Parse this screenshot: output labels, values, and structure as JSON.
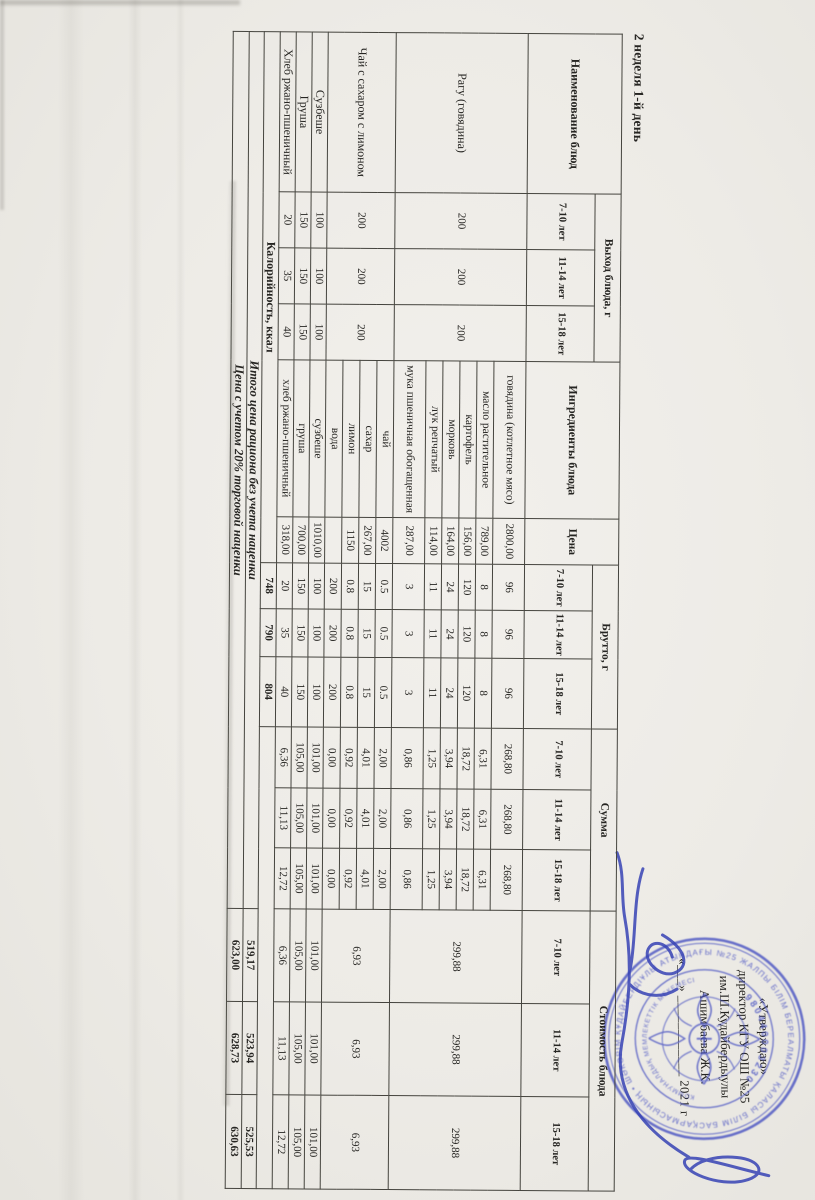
{
  "page": {
    "title": "2 неделя 1-й день"
  },
  "approval": {
    "line1": "«Утверждаю»",
    "line2": "директор КГУ ОШ №25",
    "line3": "им.Ш.Кудайбердыулы",
    "line4": "Ашимбаева Ж.К.",
    "date_line": "«___» ____________ 2021 г"
  },
  "stamp": {
    "ring_text": "АЛМАТЫ ҚАЛАСЫ БІЛІМ БАСҚАРМАСЫНЫҢ • ШӘКӘРІМ ҚҰДАЙБЕРДІҰЛЫ АТЫНДАҒЫ №25 ЖАЛПЫ БІЛІМ БЕРЕТІН МЕКТЕБІ •",
    "inner_bottom_text": "КОММУНАЛДЫҚ МЕМЛЕКЕТТІК МЕКЕМЕСІ",
    "bin": "980440003230",
    "color": "#4a53c2"
  },
  "signature_color": "#3743b5",
  "table": {
    "headers": {
      "name": "Наименование блюд",
      "yield": "Выход блюда, г",
      "ingredients": "Ингредиенты блюда",
      "price": "Цена",
      "brutto": "Брутто, г",
      "sum": "Сумма",
      "cost": "Стоимость блюда",
      "ages": [
        "7-10 лет",
        "11-14 лет",
        "15-18 лет"
      ]
    },
    "dishes": [
      {
        "name": "Рагу (говядина)",
        "yield": [
          "200",
          "200",
          "200"
        ],
        "cost": [
          "299,88",
          "299,88",
          "299,88"
        ],
        "ingredients": [
          {
            "name": "говядина (котлетное мясо)",
            "price": "2800,00",
            "brutto": [
              "96",
              "96",
              "96"
            ],
            "sum": [
              "268,80",
              "268,80",
              "268,80"
            ]
          },
          {
            "name": "масло растительное",
            "price": "789,00",
            "brutto": [
              "8",
              "8",
              "8"
            ],
            "sum": [
              "6,31",
              "6,31",
              "6,31"
            ]
          },
          {
            "name": "картофель",
            "price": "156,00",
            "brutto": [
              "120",
              "120",
              "120"
            ],
            "sum": [
              "18,72",
              "18,72",
              "18,72"
            ]
          },
          {
            "name": "морковь",
            "price": "164,00",
            "brutto": [
              "24",
              "24",
              "24"
            ],
            "sum": [
              "3,94",
              "3,94",
              "3,94"
            ]
          },
          {
            "name": "лук репчатый",
            "price": "114,00",
            "brutto": [
              "11",
              "11",
              "11"
            ],
            "sum": [
              "1,25",
              "1,25",
              "1,25"
            ]
          },
          {
            "name": "мука пшеничная обогащенная",
            "price": "287,00",
            "brutto": [
              "3",
              "3",
              "3"
            ],
            "sum": [
              "0,86",
              "0,86",
              "0,86"
            ]
          }
        ]
      },
      {
        "name": "Чай с сахаром с лимоном",
        "yield": [
          "200",
          "200",
          "200"
        ],
        "cost": [
          "6,93",
          "6,93",
          "6,93"
        ],
        "ingredients": [
          {
            "name": "чай",
            "price": "4002",
            "brutto": [
              "0.5",
              "0.5",
              "0.5"
            ],
            "sum": [
              "2,00",
              "2,00",
              "2,00"
            ]
          },
          {
            "name": "сахар",
            "price": "267,00",
            "brutto": [
              "15",
              "15",
              "15"
            ],
            "sum": [
              "4,01",
              "4,01",
              "4,01"
            ]
          },
          {
            "name": "лимон",
            "price": "1150",
            "brutto": [
              "0.8",
              "0.8",
              "0.8"
            ],
            "sum": [
              "0,92",
              "0,92",
              "0,92"
            ]
          },
          {
            "name": "вода",
            "price": "",
            "brutto": [
              "200",
              "200",
              "200"
            ],
            "sum": [
              "0,00",
              "0,00",
              "0,00"
            ]
          }
        ]
      },
      {
        "name": "Сузбеше",
        "yield": [
          "100",
          "100",
          "100"
        ],
        "cost": [
          "101,00",
          "101,00",
          "101,00"
        ],
        "ingredients": [
          {
            "name": "сузбеше",
            "price": "1010,00",
            "brutto": [
              "100",
              "100",
              "100"
            ],
            "sum": [
              "101,00",
              "101,00",
              "101,00"
            ]
          }
        ]
      },
      {
        "name": "Груша",
        "yield": [
          "150",
          "150",
          "150"
        ],
        "cost": [
          "105,00",
          "105,00",
          "105,00"
        ],
        "ingredients": [
          {
            "name": "груша",
            "price": "700,00",
            "brutto": [
              "150",
              "150",
              "150"
            ],
            "sum": [
              "105,00",
              "105,00",
              "105,00"
            ]
          }
        ]
      },
      {
        "name": "Хлеб ржано-пшеничный",
        "yield": [
          "20",
          "35",
          "40"
        ],
        "cost": [
          "6,36",
          "11,13",
          "12,72"
        ],
        "ingredients": [
          {
            "name": "хлеб ржано-пшеничный",
            "price": "318,00",
            "brutto": [
              "20",
              "35",
              "40"
            ],
            "sum": [
              "6,36",
              "11,13",
              "12,72"
            ]
          }
        ]
      }
    ],
    "calories": {
      "label": "Калорийность, ккал",
      "values": [
        "748",
        "790",
        "804"
      ]
    },
    "totals": [
      {
        "label": "Итого цена рациона без учета наценки",
        "values": [
          "519,17",
          "523,94",
          "525,53"
        ]
      },
      {
        "label": "Цена с учетом 20% торговой наценки",
        "values": [
          "623,00",
          "628,73",
          "630,63"
        ]
      }
    ]
  }
}
